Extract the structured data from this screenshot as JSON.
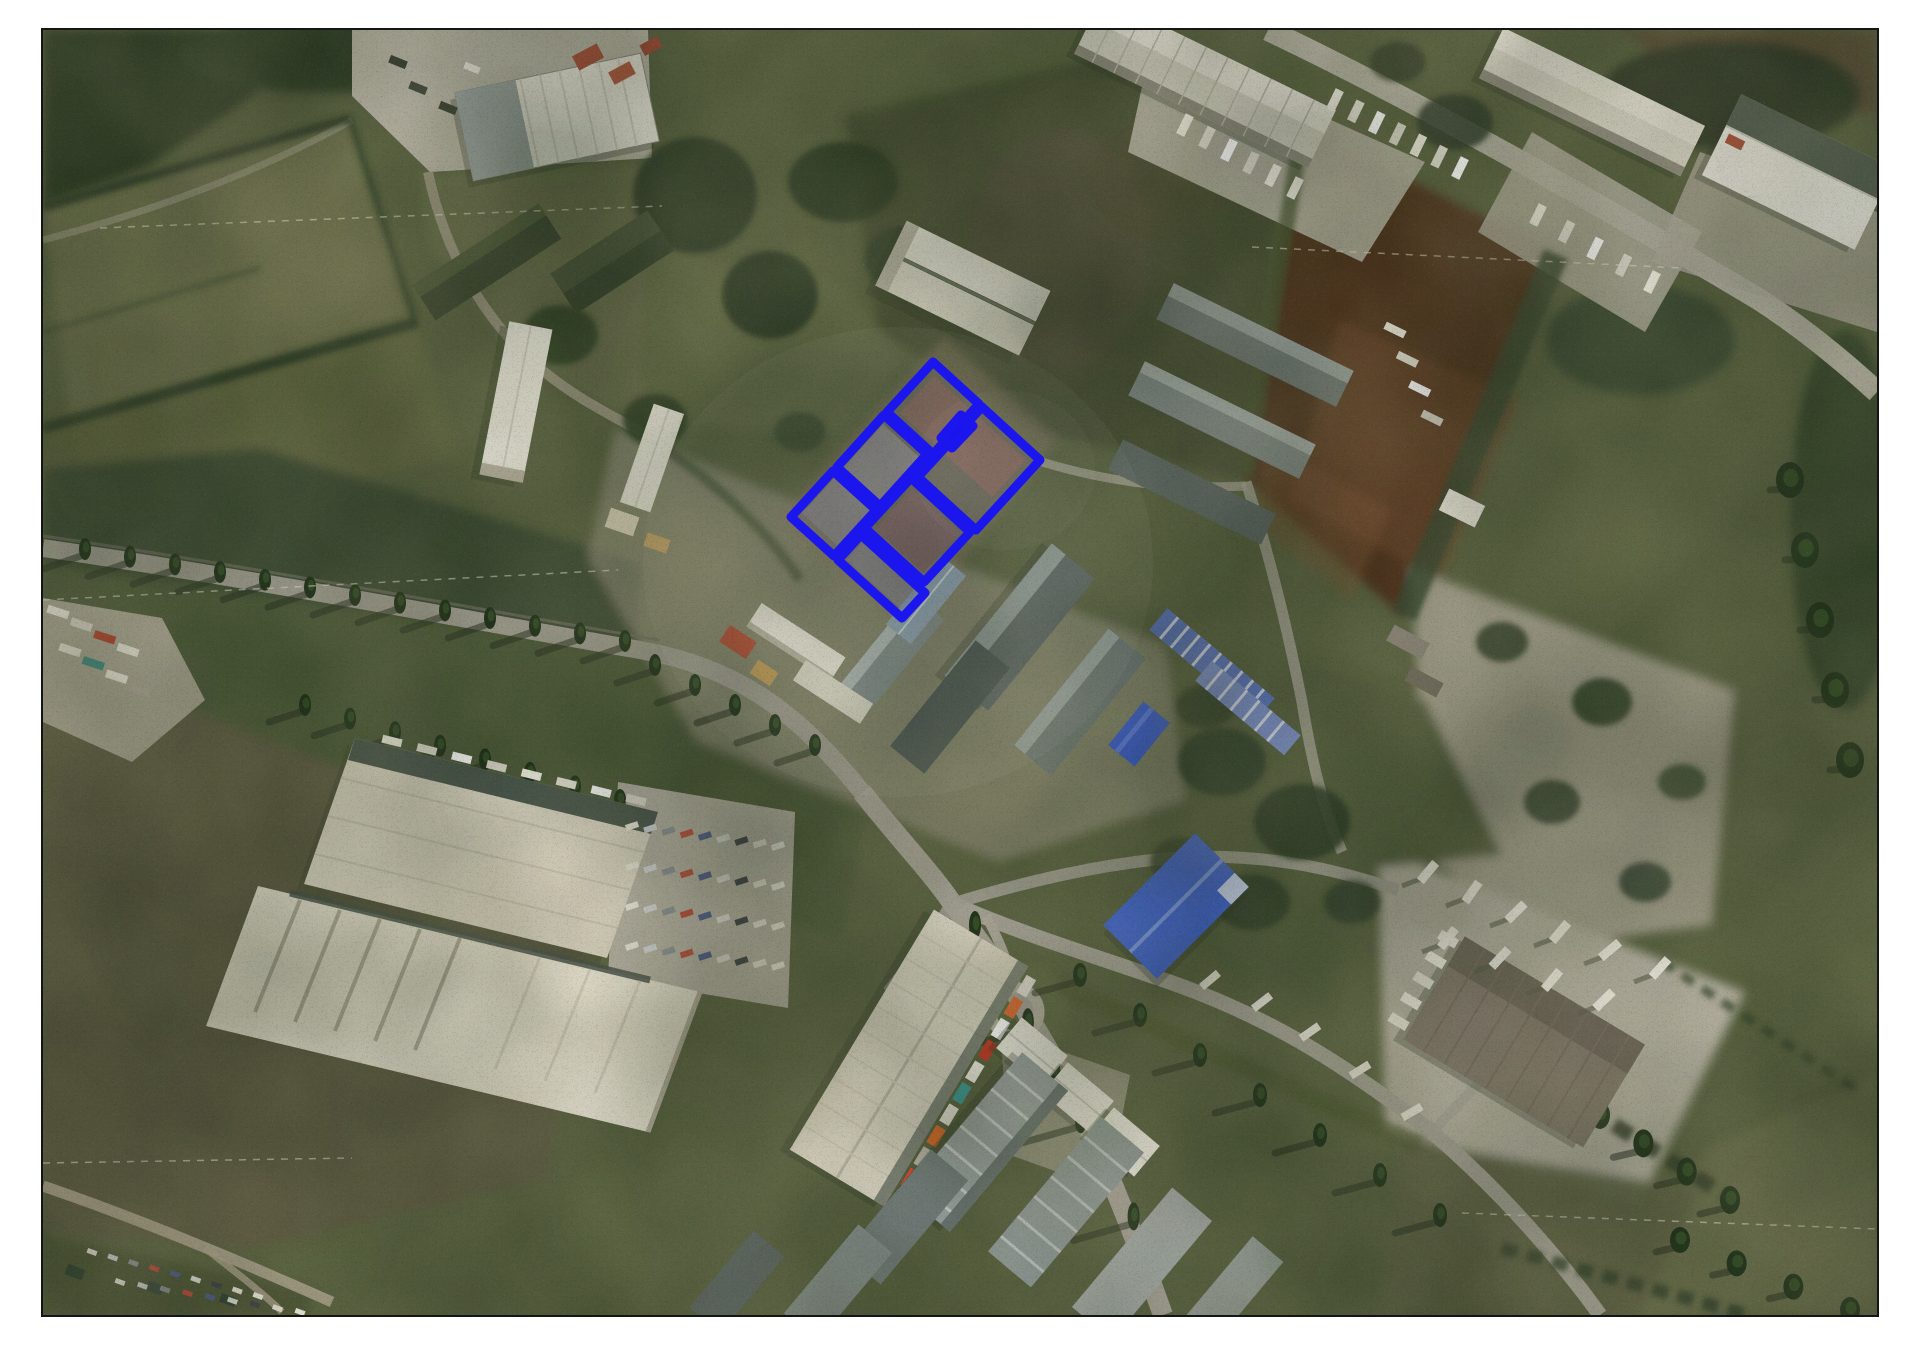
{
  "page": {
    "background": "#ffffff",
    "frame_border_color": "#151515"
  },
  "map": {
    "kind": "satellite-aerial-photo",
    "content": "aerial view of industrial area with warehouses, roads, fields and a group of cadastral parcels highlighted in blue",
    "highlight": {
      "color": "#1b15ee",
      "stroke_width": 9,
      "fill_color": "#2020e0",
      "fill_opacity": 0.06
    },
    "parcels": [
      {
        "id": "parcel-a",
        "points": "933,362 979,404 933,454 887,412"
      },
      {
        "id": "parcel-b",
        "points": "982,407 1040,460 976,530 918,477"
      },
      {
        "id": "parcel-c",
        "points": "884,415 927,454 880,506 837,467"
      },
      {
        "id": "parcel-d",
        "points": "911,478 970,532 924,582 865,528"
      },
      {
        "id": "parcel-e",
        "points": "833,471 876,510 834,556 791,517"
      },
      {
        "id": "parcel-f",
        "points": "861,535 925,593 902,618 838,560"
      },
      {
        "id": "parcel-g-connector",
        "points": "961,415 973,426 952,448 941,438"
      }
    ],
    "palette": {
      "base_green": "#57603f",
      "forest": "#2b3723",
      "field_light": "#6a6e4c",
      "plowed_field_brown": "#4e301c",
      "road": "#a4a195",
      "concrete_pad": "#b6b2a3",
      "roof_white": "#e7e4d8",
      "roof_cream": "#d6d1bf",
      "roof_gray": "#6f7877",
      "roof_dark": "#48534f",
      "roof_blue": "#4064cd",
      "roof_red": "#ad4730"
    }
  }
}
